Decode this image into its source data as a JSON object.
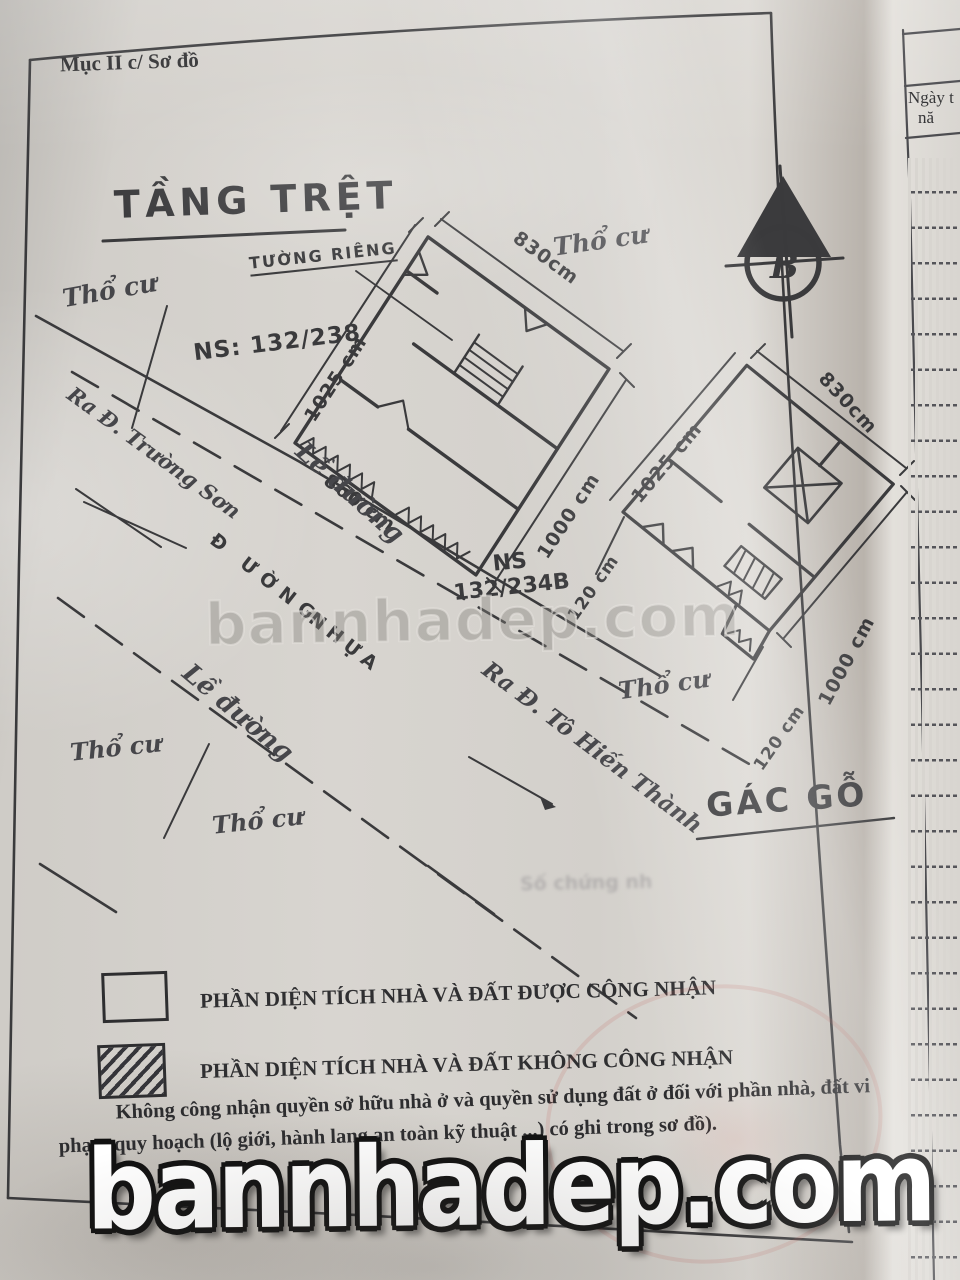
{
  "page": {
    "header_note": "Mục II c/ Sơ đồ",
    "title": "TẦNG TRỆT",
    "north_letter": "B"
  },
  "plan": {
    "wall_label": "TƯỜNG RIÊNG",
    "ns_left": "NS: 132/238",
    "ns_right_line1": "NS",
    "ns_right_line2": "132/234B",
    "gac_go": "GÁC GỖ",
    "tho_cu": "Thổ cư",
    "le_duong": "Lề đường",
    "duong_1": "Đ ƯỜNG",
    "duong_2": "NHỰA",
    "ra_truong_son": "Ra Đ. Trường Sơn",
    "ra_to_hien_thanh": "Ra Đ. Tô Hiến Thành",
    "dims": {
      "left_left": "1025 cm",
      "left_top": "830cm",
      "left_bottom": "860 cm",
      "left_right": "1000 cm",
      "right_left": "1025 cm",
      "right_top": "830cm",
      "right_right": "1000 cm",
      "right_step": "120 cm",
      "alley": "120 cm"
    }
  },
  "legend": {
    "recognized": "PHẦN DIỆN TÍCH NHÀ VÀ ĐẤT ĐƯỢC CÔNG NHẬN",
    "not_recognized": "PHẦN DIỆN TÍCH NHÀ VÀ ĐẤT KHÔNG CÔNG NHẬN"
  },
  "note": "Không công nhận quyền sở hữu nhà ở và quyền sử dụng đất ở đối với phần nhà, đất vi phạm quy hoạch (lộ giới, hành lang an toàn kỹ thuật ...) có ghi trong sơ đồ).",
  "side_page": {
    "col_header_line1": "Ngày t",
    "col_header_line2": "nă"
  },
  "watermark": {
    "text": "bannhadep.com"
  },
  "bleed_text": "Số chứng nh",
  "colors": {
    "ink": "#3a3a3c",
    "paper": "#d5d2cd",
    "stamp_red": "#c35f55"
  }
}
